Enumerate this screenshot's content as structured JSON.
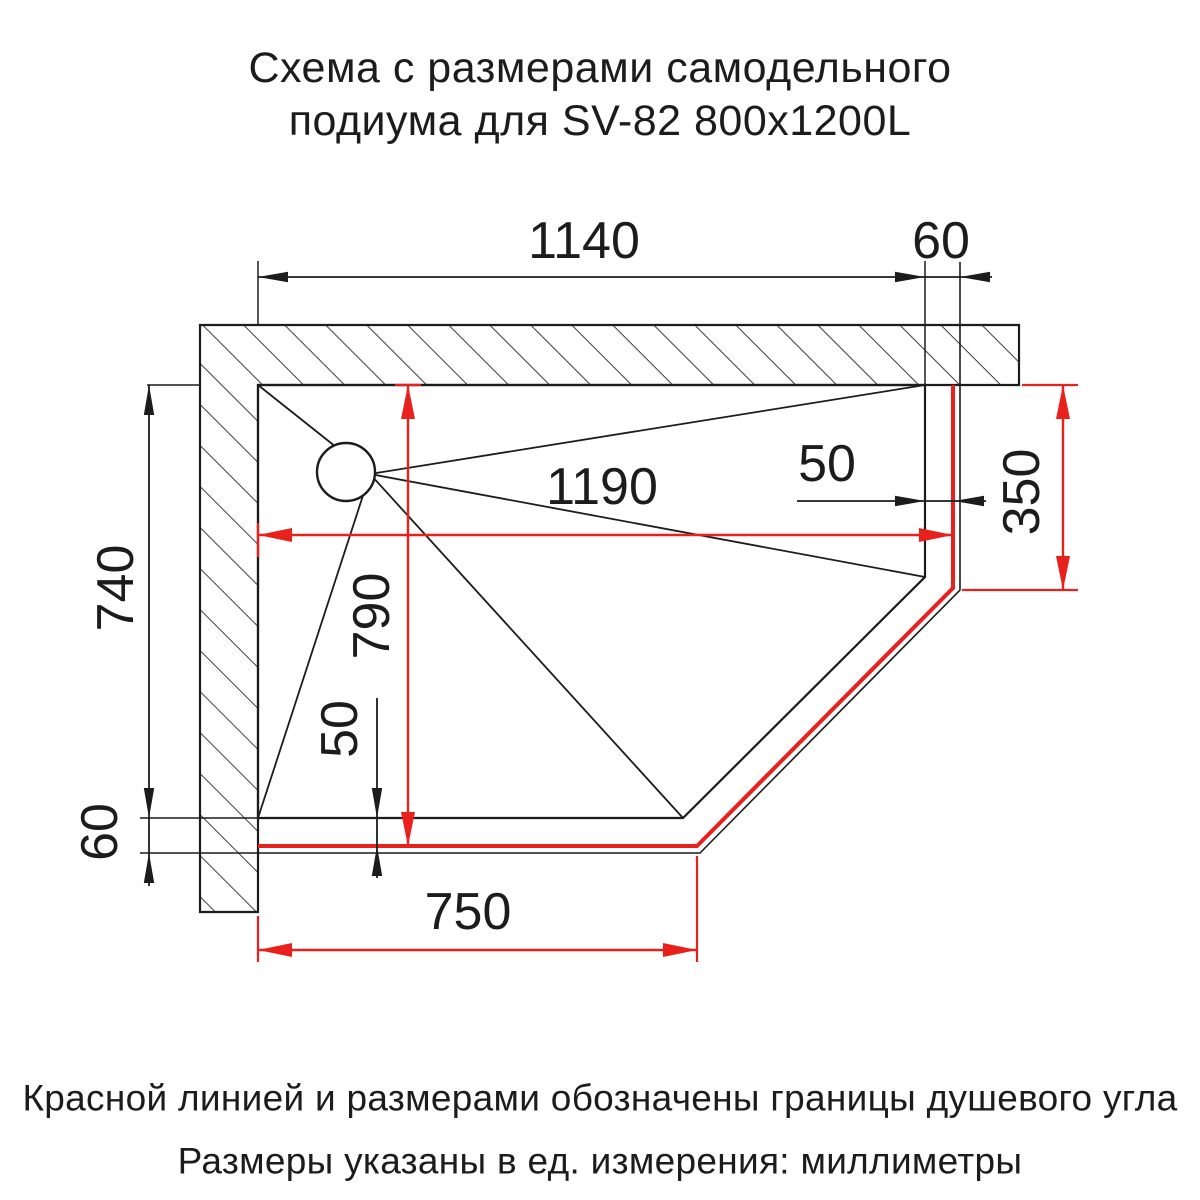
{
  "title": {
    "line1": "Схема с размерами самодельного",
    "line2": "подиума для SV-82 800x1200L"
  },
  "notes": {
    "line1": "Красной линией и размерами обозначены границы душевого угла",
    "line2": "Размеры указаны в ед. измерения: миллиметры"
  },
  "colors": {
    "accent_red": "#e8211d",
    "line_black": "#1c1c1c",
    "background": "#ffffff"
  },
  "dimensions_mm": {
    "podium_width": "1140",
    "podium_height": "740",
    "tray_overhang_right": "60",
    "tray_overhang_bottom": "60",
    "shower_corner_width": "1190",
    "shower_corner_height": "790",
    "shower_corner_right_side": "350",
    "boundary_offset_right": "50",
    "boundary_offset_bottom": "50",
    "bottom_edge_width": "750"
  }
}
